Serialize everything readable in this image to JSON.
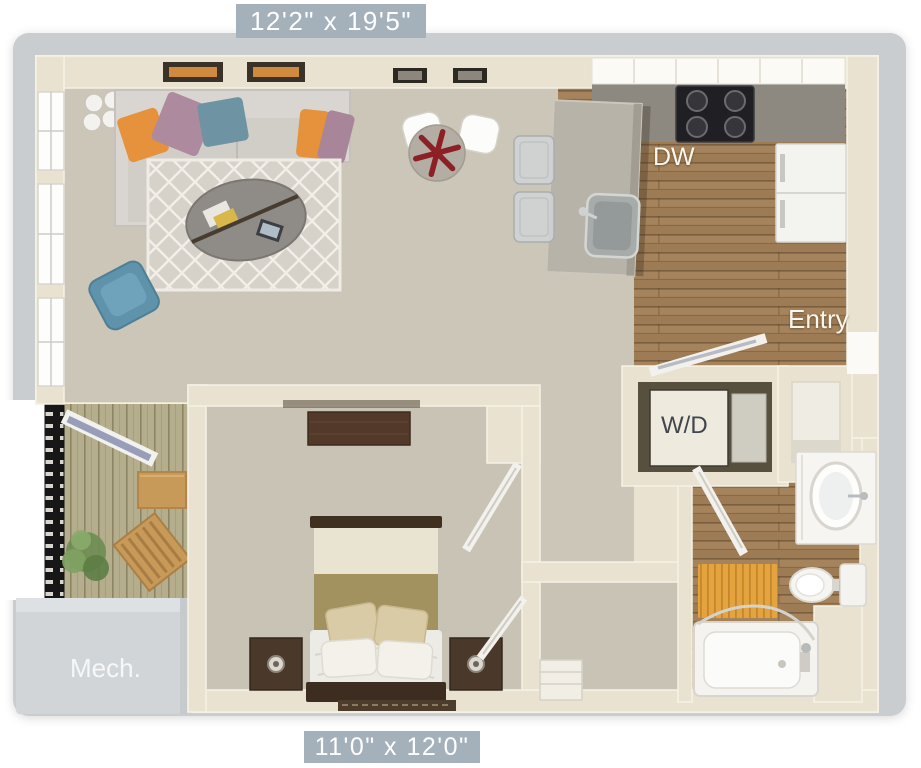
{
  "floorplan": {
    "dimensions": {
      "top": "12'2\" x 19'5\"",
      "bottom": "11'0\" x 12'0\""
    },
    "room_labels": {
      "dishwasher": "DW",
      "entry": "Entry",
      "washer_dryer": "W/D",
      "mechanical": "Mech."
    },
    "colors": {
      "dimension_label_background": "#a4b0ba",
      "dimension_label_text": "#ffffff",
      "frame_gray": "#c9cdd0",
      "wall_cream": "#e9e2d1",
      "carpet_beige": "#ccc6b9",
      "wood_floor": "#a5835c",
      "balcony_deck": "#b5ae8d",
      "label_text_light": "#faf7ee",
      "label_text_dark": "#41464c",
      "pillow_orange": "#e6913b",
      "pillow_mauve": "#ad8a9e",
      "armchair_teal": "#5e93ab",
      "bath_mat_orange": "#e3a33f",
      "table_star_red": "#8c2025"
    }
  }
}
